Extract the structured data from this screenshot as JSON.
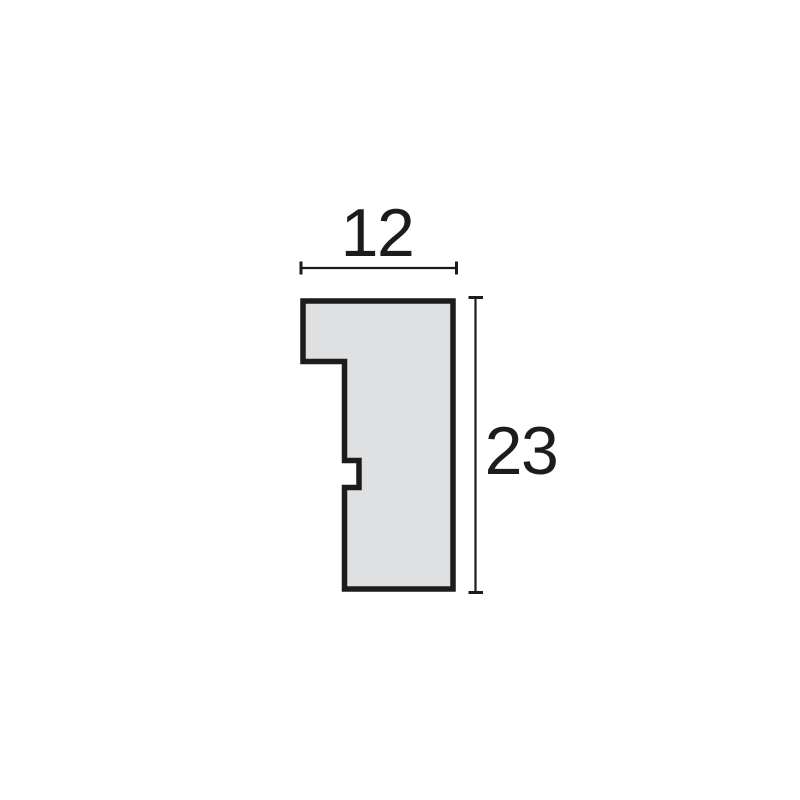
{
  "diagram": {
    "kind": "moulding-profile-cross-section",
    "width_dimension": {
      "label": "12"
    },
    "height_dimension": {
      "label": "23"
    },
    "colors": {
      "background": "#ffffff",
      "shape_fill": "#dee0e1",
      "outline": "#1c1c1a",
      "dimension_line": "#1c1c1a",
      "text": "#1c1c1a"
    }
  }
}
